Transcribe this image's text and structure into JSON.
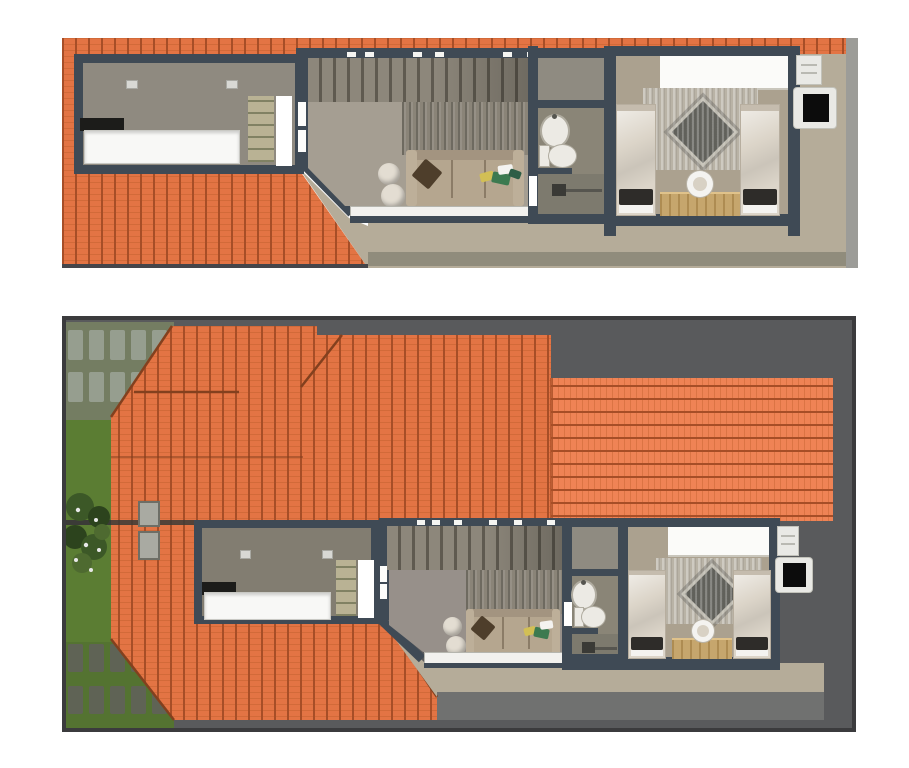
{
  "scene": {
    "description": "Two-panel 3D architectural rendering: upper-floor cutaway plan (top) and roof-level cutaway view with garden (bottom)",
    "panel_count": 2
  },
  "colors": {
    "page_bg": "#ffffff",
    "wall": "#3f4a55",
    "panel_border": "#3b3b3d",
    "bg_dark": "#595a5c",
    "road": "#707170",
    "roof_tile": "#e37444",
    "roof_line": "#a74e27",
    "roof_row": "#c4622f",
    "roof_tile_light": "#ef8355",
    "ridge": "#83401e",
    "grass": "#5b7d33",
    "grass_shadow": "#747d62",
    "grass_low": "#547331",
    "paver_light": "#969e8f",
    "paver_dark": "#5f6355",
    "bush_dark": "#2c431d",
    "bush_mid": "#3c5827",
    "bush_light": "#4e6a30",
    "floor_kitchen": "#8f8a80",
    "floor_kitchen2": "#827d71",
    "floor_living": "#a59e92",
    "floor_living2": "#97908a",
    "floor_bath": "#8a8577",
    "floor_shower": "#7d7a6e",
    "floor_bed": "#aba18f",
    "floor_closet": "#8f8b81",
    "terrace": "#b5ac99",
    "terrace_band": "#908c7c",
    "gray_strip": "#9c9c98",
    "stairs": "#8d877b",
    "stairs_line": "#5f5a50",
    "curtain": "#8a8478",
    "counter": "#f8f8f6",
    "cooktop": "#1c1c1a",
    "shelf": "#b9b294",
    "socket": "#d8d8d4",
    "sofa": "#b5a68f",
    "sofa_dark": "#a39480",
    "sofa_arm": "#bdaf99",
    "pillow_brown": "#4e3e2b",
    "pillow_green": "#3c7a50",
    "pillow_yellow": "#d2bf55",
    "pillow_teal": "#2e5e46",
    "pouf": "#e3ddd2",
    "white": "#f4f3f0",
    "balcony": "#f2f1ee",
    "fixture": "#eceae4",
    "fixture_border": "#b0aca0",
    "drain": "#3a3a36",
    "window_white": "#fbfbf9",
    "rug": "#b9b3a6",
    "rug_dark": "#61615b",
    "bed": "#dcd5c9",
    "bed_shadow": "#c5bcae",
    "pillow_dark": "#2e2c29",
    "desk": "#c6a66d",
    "ac_body": "#e9e9e5",
    "ac_black": "#0c0c0c",
    "skylight": "#a9aaa2",
    "skylight_border": "#6d6e66"
  },
  "panels": [
    {
      "id": "upper-floor-cutaway",
      "rooms": [
        {
          "name": "kitchen",
          "items": [
            "kitchen-counter",
            "cooktop",
            "shelf-unit",
            "wall-sockets",
            "door-opening"
          ]
        },
        {
          "name": "living-room",
          "items": [
            "staircase",
            "stair-rail-posts",
            "wardrobe-curtain",
            "sofa",
            "throw-pillows",
            "two-poufs",
            "balcony-rail",
            "window-slits"
          ]
        },
        {
          "name": "bathroom",
          "items": [
            "closet-nook",
            "washbasin",
            "toilet",
            "shower-drain",
            "door-opening"
          ]
        },
        {
          "name": "bedroom",
          "items": [
            "headboard-window",
            "patterned-rug",
            "twin-bed-left",
            "twin-bed-right",
            "desk",
            "chair"
          ]
        }
      ],
      "exterior": [
        "tiled-roof-strip",
        "tiled-roof-wing",
        "terrace",
        "ac-condenser",
        "ac-unit"
      ]
    },
    {
      "id": "roof-level-view",
      "rooms": [
        {
          "name": "kitchen",
          "items": [
            "kitchen-counter",
            "cooktop",
            "shelf-unit",
            "wall-sockets",
            "door-opening"
          ]
        },
        {
          "name": "living-room",
          "items": [
            "staircase",
            "stair-rail-posts",
            "wardrobe-curtain",
            "sofa",
            "throw-pillows",
            "two-poufs",
            "balcony-rail",
            "window-slits"
          ]
        },
        {
          "name": "bathroom",
          "items": [
            "closet-nook",
            "washbasin",
            "toilet",
            "shower-drain",
            "door-opening"
          ]
        },
        {
          "name": "bedroom",
          "items": [
            "headboard-window",
            "patterned-rug",
            "twin-bed-left",
            "twin-bed-right",
            "desk",
            "chair"
          ]
        }
      ],
      "exterior": [
        "hip-roof",
        "garden-grass",
        "stepping-stones",
        "shrubs",
        "skylights",
        "fence-line",
        "terrace",
        "driveway",
        "ac-condenser",
        "ac-unit"
      ]
    }
  ]
}
